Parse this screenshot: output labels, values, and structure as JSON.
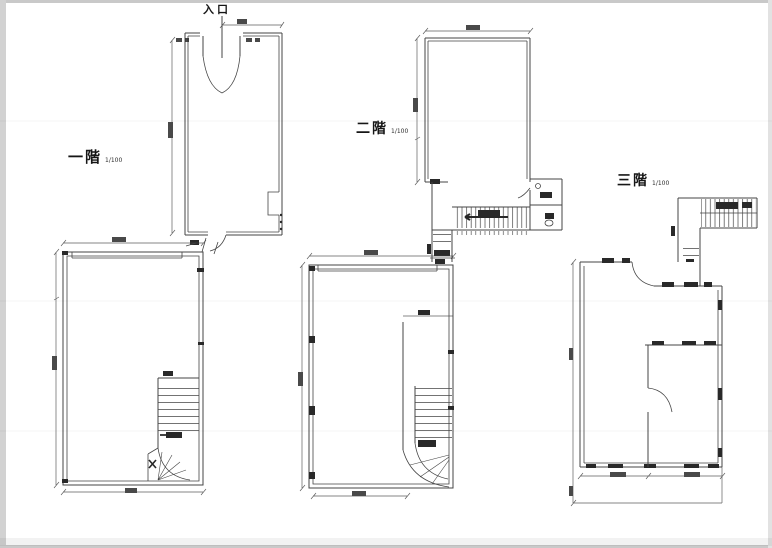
{
  "colors": {
    "ink": "#3a3a3a",
    "paper": "#ffffff",
    "edge_shadow": "#cccccc",
    "annotation": "#1c1c1c"
  },
  "plans": {
    "first": {
      "label": "一階",
      "scale": "1/100",
      "entrance_label": "入口"
    },
    "second": {
      "label": "二階",
      "scale": "1/100"
    },
    "third": {
      "label": "三階",
      "scale": "1/100"
    }
  }
}
